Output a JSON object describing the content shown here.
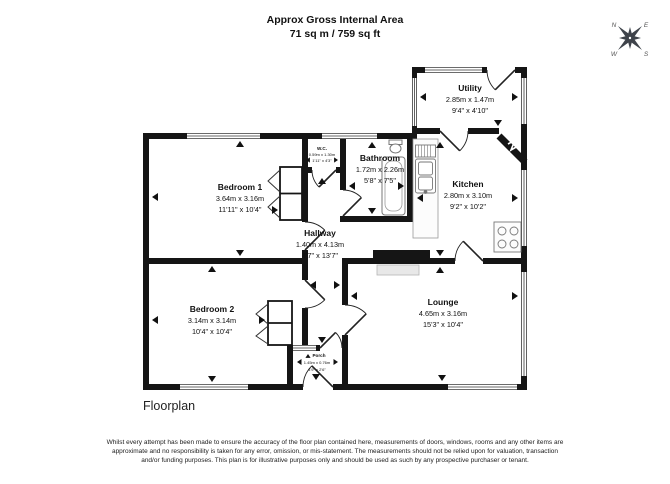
{
  "header": {
    "title_line1": "Approx Gross Internal Area",
    "title_line2": "71 sq m / 759 sq ft"
  },
  "compass": {
    "n": "N",
    "e": "E",
    "s": "S",
    "w": "W"
  },
  "rooms": {
    "bedroom1": {
      "name": "Bedroom 1",
      "metric": "3.64m x 3.16m",
      "imperial": "11'11\" x 10'4\""
    },
    "bedroom2": {
      "name": "Bedroom 2",
      "metric": "3.14m x 3.14m",
      "imperial": "10'4\" x 10'4\""
    },
    "hallway": {
      "name": "Hallway",
      "metric": "1.40m x 4.13m",
      "imperial": "4'7\" x 13'7\""
    },
    "wc": {
      "name": "W.C.",
      "metric": "0.59m x 1.30m",
      "imperial": "1'11\" x 4'3\""
    },
    "bathroom": {
      "name": "Bathroom",
      "metric": "1.72m x 2.26m",
      "imperial": "5'8\" x 7'5\""
    },
    "kitchen": {
      "name": "Kitchen",
      "metric": "2.80m x 3.10m",
      "imperial": "9'2\" x 10'2\""
    },
    "utility": {
      "name": "Utility",
      "metric": "2.85m x 1.47m",
      "imperial": "9'4\" x 4'10\""
    },
    "lounge": {
      "name": "Lounge",
      "metric": "4.65m x 3.16m",
      "imperial": "15'3\" x 10'4\""
    },
    "porch": {
      "name": "Porch",
      "metric": "1.45m x 0.76m",
      "imperial": "4'9\" x 2'6\""
    }
  },
  "caption": "Floorplan",
  "disclaimer": "Whilst every attempt has been made to ensure the accuracy of the floor plan contained here, measurements of doors, windows, rooms and any other items are approximate and no responsibility is taken for any error, omission, or mis-statement. The measurements should not be relied upon for valuation, transaction and/or funding purposes. This plan is for illustrative purposes only and should be used as such by any prospective purchaser or tenant.",
  "colors": {
    "wall": "#151515",
    "compass": "#3e434a",
    "fixture": "#777777"
  }
}
